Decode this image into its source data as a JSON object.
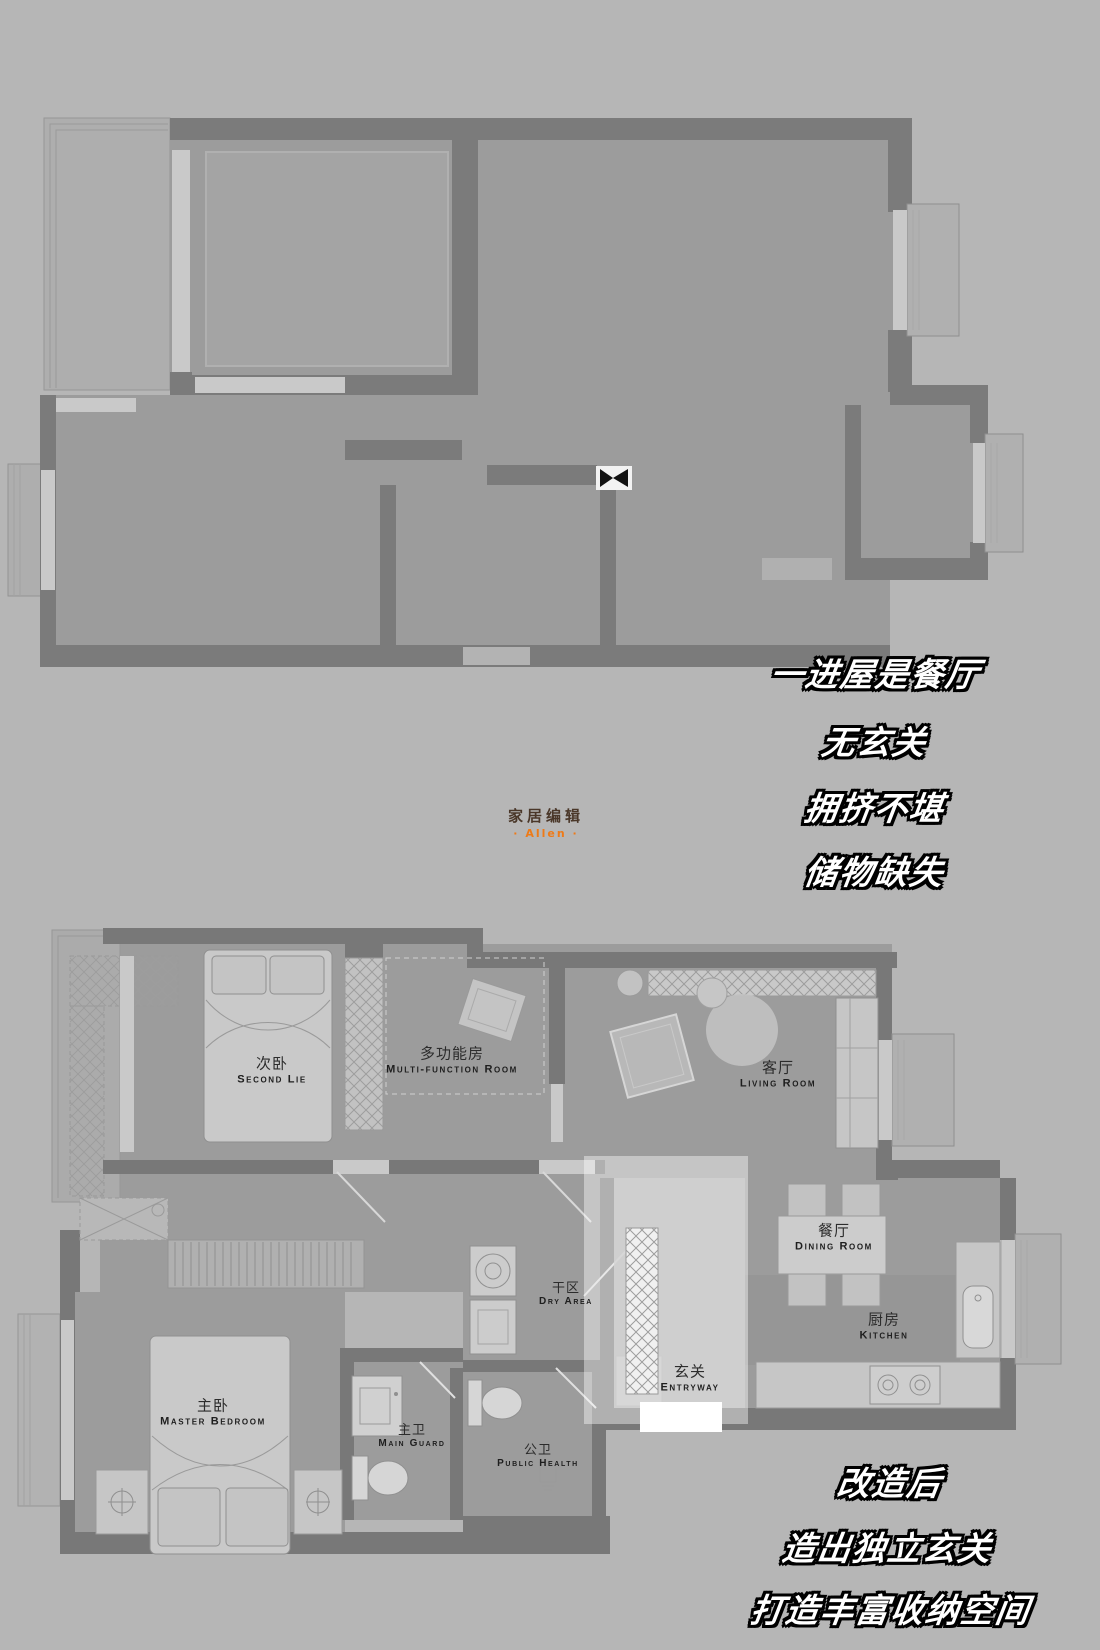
{
  "branding": {
    "logo_zh": "家居编辑",
    "logo_en": "· Allen ·"
  },
  "annotations": {
    "before_issues": [
      "一进屋是餐厅",
      "无玄关",
      "拥挤不堪",
      "储物缺失"
    ],
    "after_notes": [
      "改造后",
      "造出独立玄关",
      "打造丰富收纳空间"
    ]
  },
  "plans": {
    "after": {
      "rooms": [
        {
          "zh": "次卧",
          "en": "Second Lie"
        },
        {
          "zh": "多功能房",
          "en": "Multi-function Room"
        },
        {
          "zh": "客厅",
          "en": "Living Room"
        },
        {
          "zh": "餐厅",
          "en": "Dining Room"
        },
        {
          "zh": "厨房",
          "en": "Kitchen"
        },
        {
          "zh": "玄关",
          "en": "Entryway"
        },
        {
          "zh": "干区",
          "en": "Dry Area"
        },
        {
          "zh": "主卧",
          "en": "Master Bedroom"
        },
        {
          "zh": "主卫",
          "en": "Main Guard"
        },
        {
          "zh": "公卫",
          "en": "Public Health"
        }
      ]
    }
  },
  "colors": {
    "background": "#b6b6b6",
    "wall": "#7b7b7b",
    "floor": "#9c9c9c",
    "window": "#c9c9c9",
    "furniture": "#c6c6c6",
    "entry_highlight": "#ffffff",
    "label_text": "#2c2c2c",
    "annotation_fill": "#ffffff",
    "annotation_outline": "#000000",
    "logo_brown": "#4a3729",
    "logo_orange": "#ee7a17"
  }
}
